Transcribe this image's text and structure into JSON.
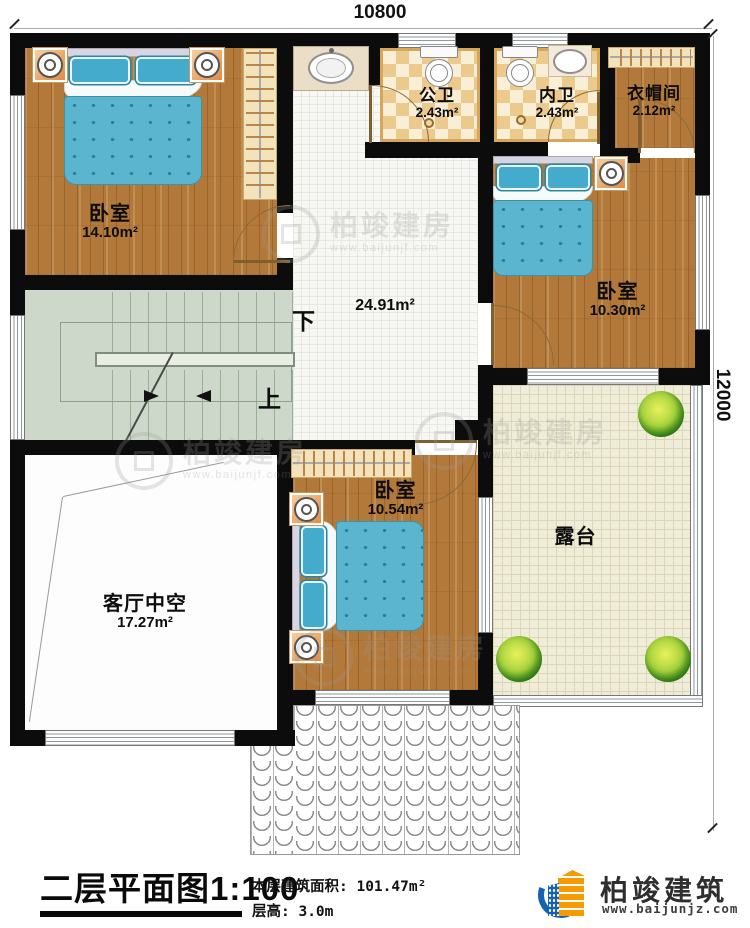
{
  "dimensions": {
    "top": "10800",
    "right": "12000"
  },
  "rooms": {
    "bedroom1": {
      "name": "卧室",
      "area": "14.10m²"
    },
    "public_bath": {
      "name": "公卫",
      "area": "2.43m²"
    },
    "inner_bath": {
      "name": "内卫",
      "area": "2.43m²"
    },
    "cloakroom": {
      "name": "衣帽间",
      "area": "2.12m²"
    },
    "hall": {
      "area": "24.91m²"
    },
    "bedroom2": {
      "name": "卧室",
      "area": "10.30m²"
    },
    "bedroom3": {
      "name": "卧室",
      "area": "10.54m²"
    },
    "living_void": {
      "name": "客厅中空",
      "area": "17.27m²"
    },
    "terrace": {
      "name": "露台"
    }
  },
  "stairs": {
    "down_label": "下",
    "up_label": "上"
  },
  "title_block": {
    "title": "二层平面图",
    "scale": "1:100",
    "area_label": "本层建筑面积:",
    "area_value": "101.47m²",
    "floor_height_label": "层高:",
    "floor_height_value": "3.0m"
  },
  "brand": {
    "name": "柏竣建筑",
    "website": "www.baijunjz.com"
  },
  "watermark": {
    "name": "柏竣建房",
    "website": "www.baijunjf.com"
  }
}
